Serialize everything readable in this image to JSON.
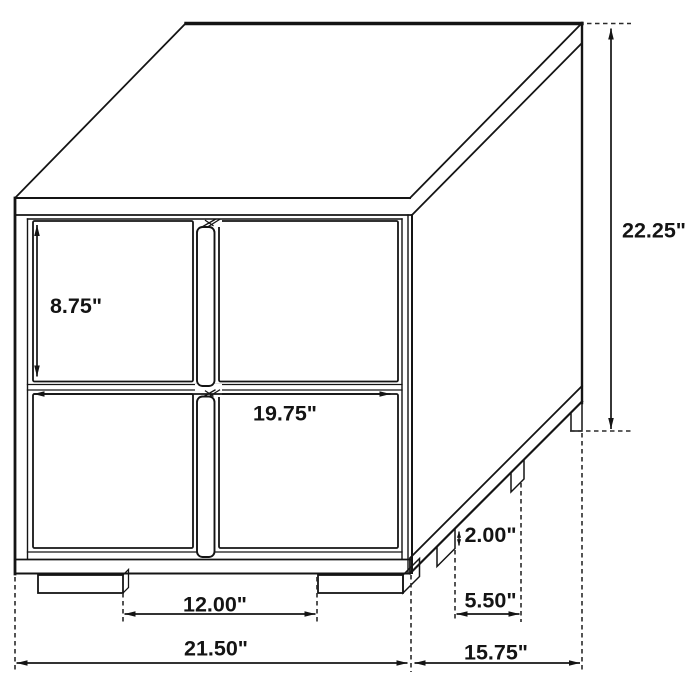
{
  "diagram": {
    "kind": "product-dimension-line-drawing",
    "background_color": "#ffffff",
    "line_color": "#141414",
    "text_color": "#141414"
  },
  "dimensions": {
    "drawer_front_height": "8.75\"",
    "front_opening_width": "19.75\"",
    "overall_height": "22.25\"",
    "foot_height": "2.00\"",
    "side_feet_spacing": "5.50\"",
    "front_feet_spacing": "12.00\"",
    "overall_width": "21.50\"",
    "overall_depth": "15.75\""
  }
}
